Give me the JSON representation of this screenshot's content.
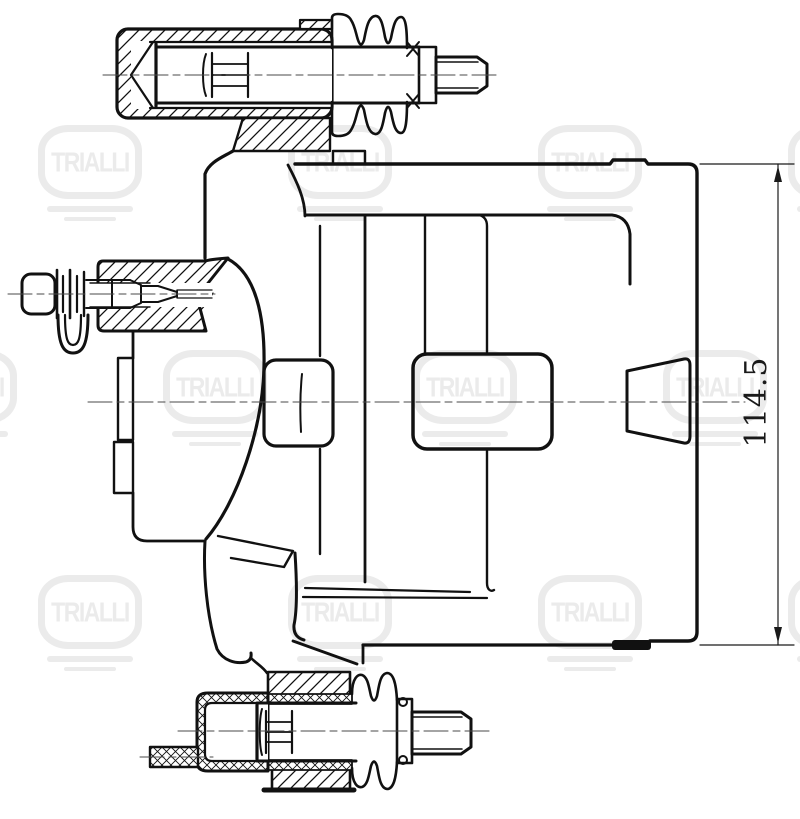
{
  "dimension": {
    "value": "114.5"
  },
  "watermark": {
    "text": "TRIALLI"
  },
  "colors": {
    "line": "#111111",
    "centerline": "#4a4a4a",
    "watermark": "#ebebeb",
    "background": "#ffffff",
    "dimension": "#1a1a1a"
  }
}
